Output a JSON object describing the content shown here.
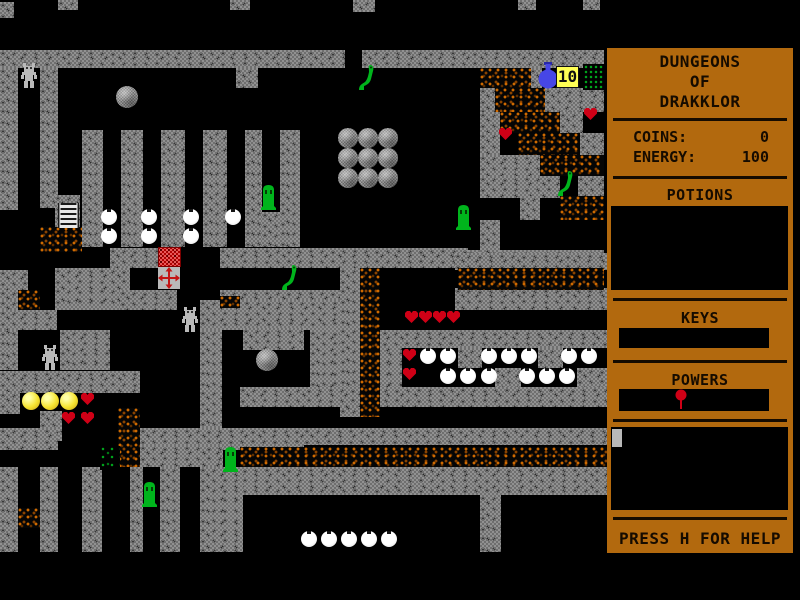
{
  "window": {
    "width": 800,
    "height": 600,
    "background": "#000000"
  },
  "map": {
    "area": {
      "x": 0,
      "y": 0,
      "w": 604,
      "h": 600
    },
    "colors": {
      "wall": "#919191",
      "rubble": "#cf6a00",
      "moss": "#00a61c",
      "creature_green": "#00b41c",
      "heart_red": "#cf0016",
      "coin_yellow": "#f6e432",
      "flask_blue": "#4646e6",
      "badge_bg": "#ffff55",
      "chest_red": "#b00000"
    },
    "badge": {
      "label": "10"
    },
    "walls": [
      [
        0,
        2,
        14,
        16
      ],
      [
        58,
        0,
        20,
        10
      ],
      [
        230,
        0,
        20,
        10
      ],
      [
        353,
        0,
        22,
        12
      ],
      [
        518,
        0,
        18,
        10
      ],
      [
        583,
        0,
        17,
        10
      ],
      [
        0,
        50,
        345,
        18
      ],
      [
        362,
        50,
        242,
        18
      ],
      [
        0,
        68,
        18,
        142
      ],
      [
        40,
        68,
        18,
        140
      ],
      [
        236,
        68,
        22,
        20
      ],
      [
        82,
        130,
        21,
        117
      ],
      [
        121,
        130,
        22,
        117
      ],
      [
        161,
        130,
        24,
        117
      ],
      [
        203,
        130,
        24,
        117
      ],
      [
        245,
        130,
        17,
        117
      ],
      [
        280,
        130,
        20,
        117
      ],
      [
        262,
        212,
        18,
        35
      ],
      [
        55,
        195,
        25,
        57
      ],
      [
        110,
        248,
        50,
        20
      ],
      [
        220,
        248,
        248,
        20
      ],
      [
        468,
        250,
        136,
        18
      ],
      [
        0,
        270,
        28,
        20
      ],
      [
        0,
        290,
        18,
        20
      ],
      [
        0,
        300,
        18,
        70
      ],
      [
        55,
        268,
        75,
        42
      ],
      [
        120,
        290,
        57,
        20
      ],
      [
        220,
        290,
        120,
        20
      ],
      [
        200,
        300,
        140,
        30
      ],
      [
        0,
        310,
        57,
        20
      ],
      [
        60,
        330,
        50,
        40
      ],
      [
        243,
        328,
        61,
        22
      ],
      [
        310,
        330,
        92,
        57
      ],
      [
        338,
        330,
        270,
        18
      ],
      [
        200,
        330,
        22,
        120
      ],
      [
        0,
        371,
        140,
        22
      ],
      [
        0,
        392,
        20,
        22
      ],
      [
        40,
        411,
        22,
        30
      ],
      [
        340,
        268,
        20,
        149
      ],
      [
        455,
        253,
        153,
        17
      ],
      [
        455,
        288,
        153,
        22
      ],
      [
        458,
        348,
        24,
        20
      ],
      [
        538,
        348,
        25,
        20
      ],
      [
        495,
        368,
        26,
        22
      ],
      [
        577,
        368,
        31,
        22
      ],
      [
        240,
        387,
        368,
        20
      ],
      [
        0,
        428,
        58,
        22
      ],
      [
        140,
        428,
        164,
        22
      ],
      [
        304,
        428,
        304,
        17
      ],
      [
        140,
        445,
        83,
        22
      ],
      [
        220,
        467,
        388,
        28
      ],
      [
        0,
        467,
        18,
        85
      ],
      [
        40,
        467,
        18,
        85
      ],
      [
        82,
        467,
        20,
        85
      ],
      [
        130,
        467,
        13,
        85
      ],
      [
        160,
        467,
        20,
        85
      ],
      [
        200,
        467,
        43,
        85
      ],
      [
        480,
        495,
        21,
        57
      ],
      [
        480,
        88,
        15,
        24
      ],
      [
        545,
        88,
        59,
        24
      ],
      [
        480,
        112,
        20,
        21
      ],
      [
        560,
        112,
        23,
        21
      ],
      [
        480,
        133,
        20,
        22
      ],
      [
        580,
        133,
        24,
        22
      ],
      [
        480,
        155,
        60,
        21
      ],
      [
        480,
        176,
        80,
        22
      ],
      [
        578,
        176,
        26,
        22
      ],
      [
        520,
        196,
        20,
        24
      ],
      [
        480,
        220,
        20,
        33
      ],
      [
        530,
        68,
        12,
        20
      ]
    ],
    "rubble": [
      [
        480,
        68,
        51,
        20
      ],
      [
        495,
        88,
        50,
        24
      ],
      [
        500,
        112,
        60,
        21
      ],
      [
        518,
        133,
        62,
        22
      ],
      [
        540,
        155,
        64,
        21
      ],
      [
        560,
        196,
        44,
        24
      ],
      [
        40,
        227,
        42,
        25
      ],
      [
        18,
        290,
        22,
        20
      ],
      [
        220,
        296,
        20,
        12
      ],
      [
        458,
        268,
        146,
        22
      ],
      [
        360,
        268,
        20,
        149
      ],
      [
        118,
        408,
        22,
        59
      ],
      [
        240,
        447,
        368,
        20
      ],
      [
        18,
        508,
        22,
        20
      ]
    ],
    "moss_sparse": [
      [
        100,
        446,
        20,
        24
      ]
    ],
    "moss_dense": [
      [
        583,
        64,
        21,
        26
      ]
    ],
    "sprites": [
      {
        "type": "robot",
        "x": 20,
        "y": 63,
        "player": true
      },
      {
        "type": "robot",
        "x": 181,
        "y": 307
      },
      {
        "type": "robot",
        "x": 41,
        "y": 345
      },
      {
        "type": "gray-ball",
        "x": 116,
        "y": 86
      },
      {
        "type": "gray-ball",
        "x": 256,
        "y": 349
      },
      {
        "type": "stone",
        "x": 338,
        "y": 128
      },
      {
        "type": "stone",
        "x": 358,
        "y": 128
      },
      {
        "type": "stone",
        "x": 378,
        "y": 128
      },
      {
        "type": "stone",
        "x": 338,
        "y": 148
      },
      {
        "type": "stone",
        "x": 358,
        "y": 148
      },
      {
        "type": "stone",
        "x": 378,
        "y": 148
      },
      {
        "type": "stone",
        "x": 338,
        "y": 168
      },
      {
        "type": "stone",
        "x": 358,
        "y": 168
      },
      {
        "type": "stone",
        "x": 378,
        "y": 168
      },
      {
        "type": "snake",
        "x": 357,
        "y": 63
      },
      {
        "type": "snake",
        "x": 556,
        "y": 169
      },
      {
        "type": "snake",
        "x": 280,
        "y": 263
      },
      {
        "type": "tombstone",
        "x": 259,
        "y": 183
      },
      {
        "type": "tombstone",
        "x": 454,
        "y": 203
      },
      {
        "type": "tombstone",
        "x": 221,
        "y": 445
      },
      {
        "type": "tombstone",
        "x": 140,
        "y": 480
      },
      {
        "type": "heart",
        "x": 583,
        "y": 107
      },
      {
        "type": "heart",
        "x": 498,
        "y": 127
      },
      {
        "type": "heart",
        "x": 404,
        "y": 310
      },
      {
        "type": "heart",
        "x": 418,
        "y": 310
      },
      {
        "type": "heart",
        "x": 432,
        "y": 310
      },
      {
        "type": "heart",
        "x": 446,
        "y": 310
      },
      {
        "type": "heart",
        "x": 402,
        "y": 348
      },
      {
        "type": "heart",
        "x": 402,
        "y": 367
      },
      {
        "type": "heart",
        "x": 80,
        "y": 392
      },
      {
        "type": "heart",
        "x": 61,
        "y": 411
      },
      {
        "type": "heart",
        "x": 80,
        "y": 411
      },
      {
        "type": "coin",
        "x": 22,
        "y": 392
      },
      {
        "type": "coin",
        "x": 41,
        "y": 392
      },
      {
        "type": "coin",
        "x": 60,
        "y": 392
      },
      {
        "type": "white-ball",
        "x": 101,
        "y": 209
      },
      {
        "type": "white-ball",
        "x": 101,
        "y": 228
      },
      {
        "type": "white-ball",
        "x": 141,
        "y": 209
      },
      {
        "type": "white-ball",
        "x": 141,
        "y": 228
      },
      {
        "type": "white-ball",
        "x": 183,
        "y": 209
      },
      {
        "type": "white-ball",
        "x": 183,
        "y": 228
      },
      {
        "type": "white-ball",
        "x": 225,
        "y": 209
      },
      {
        "type": "white-ball",
        "x": 420,
        "y": 348
      },
      {
        "type": "white-ball",
        "x": 440,
        "y": 348
      },
      {
        "type": "white-ball",
        "x": 481,
        "y": 348
      },
      {
        "type": "white-ball",
        "x": 501,
        "y": 348
      },
      {
        "type": "white-ball",
        "x": 521,
        "y": 348
      },
      {
        "type": "white-ball",
        "x": 561,
        "y": 348
      },
      {
        "type": "white-ball",
        "x": 581,
        "y": 348
      },
      {
        "type": "white-ball",
        "x": 440,
        "y": 368
      },
      {
        "type": "white-ball",
        "x": 460,
        "y": 368
      },
      {
        "type": "white-ball",
        "x": 481,
        "y": 368
      },
      {
        "type": "white-ball",
        "x": 519,
        "y": 368
      },
      {
        "type": "white-ball",
        "x": 539,
        "y": 368
      },
      {
        "type": "white-ball",
        "x": 559,
        "y": 368
      },
      {
        "type": "white-ball",
        "x": 301,
        "y": 531
      },
      {
        "type": "white-ball",
        "x": 321,
        "y": 531
      },
      {
        "type": "white-ball",
        "x": 341,
        "y": 531
      },
      {
        "type": "white-ball",
        "x": 361,
        "y": 531
      },
      {
        "type": "white-ball",
        "x": 381,
        "y": 531
      },
      {
        "type": "ladder",
        "x": 58,
        "y": 203
      },
      {
        "type": "chest",
        "x": 158,
        "y": 247
      },
      {
        "type": "cross",
        "x": 158,
        "y": 267
      },
      {
        "type": "flask",
        "x": 537,
        "y": 62
      },
      {
        "type": "badge10",
        "x": 556,
        "y": 66
      }
    ]
  },
  "sidebar": {
    "panel_color": "#b2690e",
    "title_lines": [
      "DUNGEONS",
      "OF",
      "DRAKKLOR"
    ],
    "coins_label": "COINS:",
    "coins_value": "0",
    "energy_label": "ENERGY:",
    "energy_value": "100",
    "potions_label": "POTIONS",
    "keys_label": "KEYS",
    "powers_label": "POWERS",
    "help_text": "PRESS H FOR HELP"
  }
}
